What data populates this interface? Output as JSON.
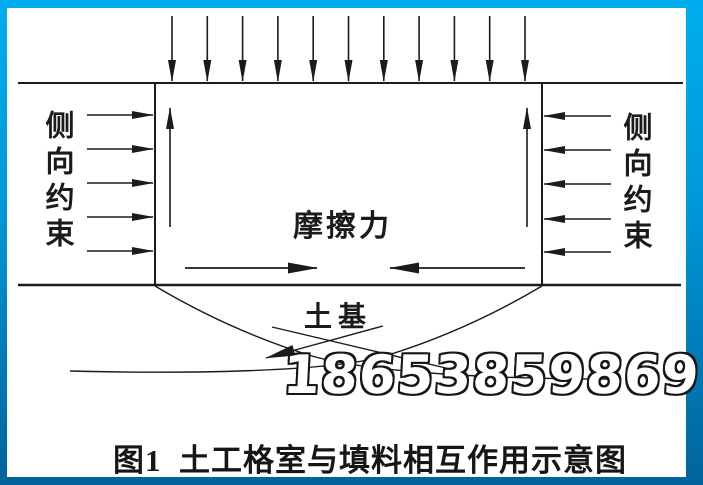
{
  "figure": {
    "caption": "图1  土工格室与填料相互作用示意图",
    "watermark": "18653859869",
    "labels": {
      "left_confinement": "侧向约束",
      "right_confinement": "侧向约束",
      "friction": "摩擦力",
      "subgrade": "土基"
    },
    "colors": {
      "frame_top": "#00AEEF",
      "frame_mid": "#0096D6",
      "frame_bottom": "#02639B",
      "background": "#FFFFFF",
      "line": "#1b1b1b",
      "watermark_fill": "#FFFFFF",
      "watermark_outline": "#161616"
    },
    "geometry": {
      "top_line": {
        "x1": 18,
        "y1": 83,
        "x2": 683,
        "y2": 83,
        "width": 2
      },
      "bottom_line": {
        "x1": 18,
        "y1": 285,
        "x2": 681,
        "y2": 285,
        "width": 2.6
      },
      "cell_walls": {
        "left_x": 155,
        "right_x": 542,
        "top_y": 83,
        "bottom_y": 285,
        "width": 2
      },
      "load_arrows": {
        "count": 11,
        "x_start": 172,
        "x_end": 525,
        "y_tail": 16,
        "y_tip": 81
      },
      "left_confine_arrows": {
        "ys": [
          115,
          149,
          183,
          217,
          251
        ],
        "x_tail": 87,
        "x_tip": 153
      },
      "right_confine_arrows": {
        "ys": [
          116,
          150,
          184,
          219,
          252
        ],
        "x_tail": 611,
        "x_tip": 544
      },
      "uplift_arrows": {
        "xs": [
          170,
          527
        ],
        "y_tail": 227,
        "y_tip": 108
      },
      "friction_arrows": [
        {
          "x_tail": 185,
          "y_tail": 268,
          "x_tip": 317,
          "y_tip": 268
        },
        {
          "x_tail": 525,
          "y_tail": 268,
          "x_tip": 390,
          "y_tip": 268
        }
      ],
      "leader_lines": [
        {
          "x1": 383,
          "y1": 326,
          "x2": 266,
          "y2": 358,
          "arrow": true
        },
        {
          "x1": 272,
          "y1": 327,
          "x2": 450,
          "y2": 369,
          "arrow": false
        }
      ],
      "slip_curves": [
        "M542,286 C505,308 450,336 385,356 C330,372 185,374 70,371",
        "M155,286 C192,308 247,336 312,356 C367,372 490,379 610,379"
      ]
    }
  }
}
